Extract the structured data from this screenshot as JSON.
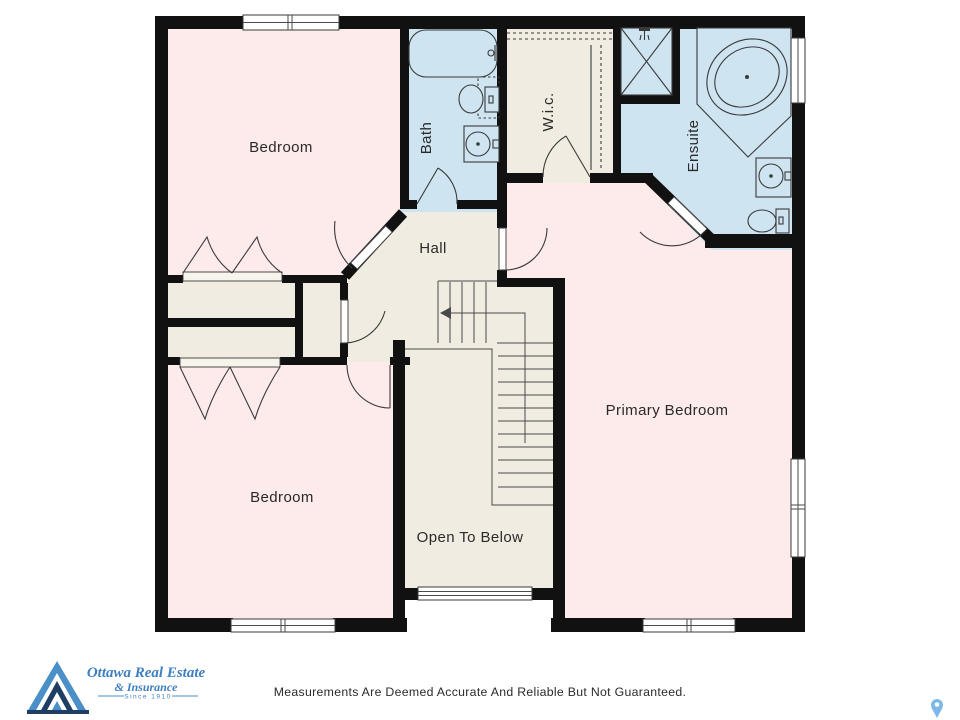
{
  "floorplan": {
    "rooms": {
      "bedroom_top": "Bedroom",
      "bath": "Bath",
      "wic": "W.i.c.",
      "ensuite": "Ensuite",
      "hall": "Hall",
      "primary_bedroom": "Primary Bedroom",
      "bedroom_bottom": "Bedroom",
      "open_to_below": "Open To Below"
    },
    "colors": {
      "room_pink": "#fcebea",
      "wet_room_blue": "#cee4f0",
      "hall_beige": "#f1ece1",
      "wall_black": "#111111",
      "fixture_line": "#3a3a3a",
      "pin_blue": "#7db9e8"
    },
    "icons": {
      "shower_head": "shower-head-icon",
      "map_pin": "map-pin-icon",
      "logo_triangle": "logo-triangle-icon"
    }
  },
  "branding": {
    "name_line1": "Ottawa Real Estate",
    "name_line2": "& Insurance",
    "tagline": "Since 1910",
    "logo_blue": "#3d7fc1",
    "logo_navy": "#1e3f63"
  },
  "footer": {
    "disclaimer": "Measurements Are Deemed Accurate And Reliable But Not Guaranteed."
  }
}
